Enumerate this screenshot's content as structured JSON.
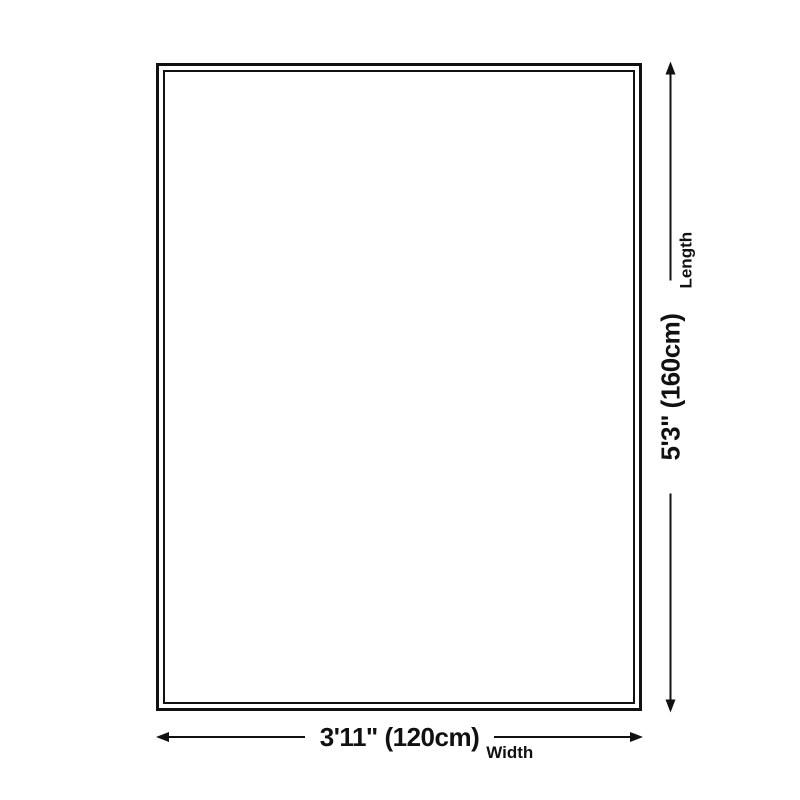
{
  "diagram": {
    "type": "product-size-dimension-diagram",
    "width_dimension": {
      "value": "3'11\" (120cm)",
      "label": "Width"
    },
    "length_dimension": {
      "value": "5'3\" (160cm)",
      "label": "Length"
    }
  },
  "colors": {
    "ink": "#111111",
    "background": "#ffffff"
  }
}
